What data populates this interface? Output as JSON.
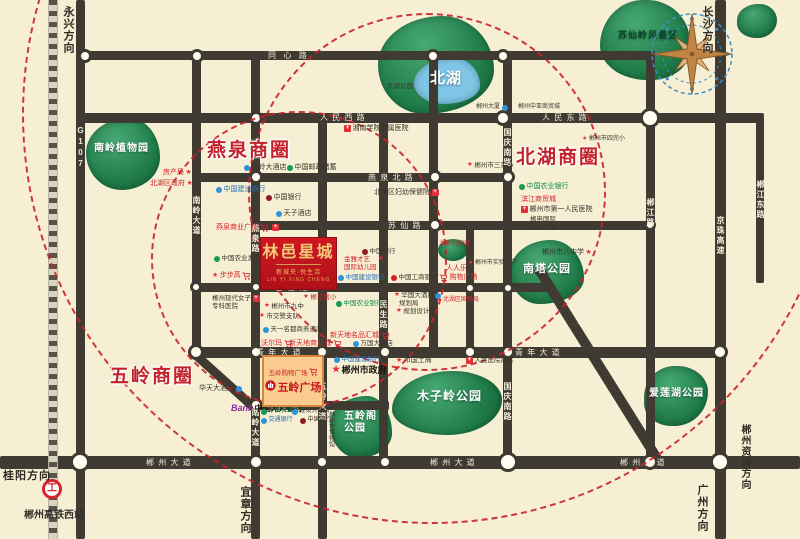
{
  "map": {
    "bg_color": "#f7efd4",
    "road_color": "#3f3b33",
    "circle_color": "#c9232b",
    "accent_red": "#c2232b",
    "brand": {
      "name": "林邑星城",
      "subtitle": "新城央·悦生活",
      "english": "LIN YI XING CHENG",
      "x": 260,
      "y": 237,
      "w": 77,
      "h": 53
    },
    "plaza": {
      "name": "五岭广场",
      "shop_label": "五岭购物广场",
      "x": 262,
      "y": 355,
      "w": 62,
      "h": 52
    },
    "station": {
      "label": "郴州高铁西站",
      "icon_x": 42,
      "icon_y": 479,
      "label_x": 24,
      "label_y": 506
    },
    "compass": {
      "x": 646,
      "y": 8
    },
    "railway": {
      "x": 48,
      "y": 0,
      "h": 539
    },
    "business_circles": [
      {
        "label": "燕泉商圈",
        "x": 207,
        "y": 135
      },
      {
        "label": "北湖商圈",
        "x": 516,
        "y": 142
      },
      {
        "label": "五岭商圈",
        "x": 110,
        "y": 361
      }
    ],
    "dashed_circles": [
      {
        "cx": 425,
        "cy": 190,
        "r": 177
      },
      {
        "cx": 297,
        "cy": 257,
        "r": 146
      },
      {
        "cx": 430,
        "cy": 112,
        "r": 408
      }
    ],
    "directions": [
      {
        "label": "永兴方向",
        "x": 60,
        "y": 6,
        "v": 1
      },
      {
        "label": "长沙方向",
        "x": 699,
        "y": 6,
        "v": 1
      },
      {
        "label": "桂阳方向",
        "x": 3,
        "y": 467,
        "v": 0
      },
      {
        "label": "宜章方向",
        "x": 237,
        "y": 486,
        "v": 1
      },
      {
        "label": "广州方向",
        "x": 694,
        "y": 484,
        "v": 1
      },
      {
        "label": "郴州资兴方向",
        "x": 737,
        "y": 424,
        "v": 1,
        "fs": 10
      }
    ],
    "roads": [
      {
        "x": 76,
        "y": 0,
        "w": 9,
        "h": 539
      },
      {
        "x": 192,
        "y": 51,
        "w": 9,
        "h": 306
      },
      {
        "x": 251,
        "y": 51,
        "w": 9,
        "h": 488
      },
      {
        "x": 318,
        "y": 113,
        "w": 9,
        "h": 426
      },
      {
        "x": 379,
        "y": 113,
        "w": 9,
        "h": 352
      },
      {
        "x": 429,
        "y": 51,
        "w": 9,
        "h": 306
      },
      {
        "x": 466,
        "y": 221,
        "w": 8,
        "h": 136
      },
      {
        "x": 503,
        "y": 51,
        "w": 9,
        "h": 414
      },
      {
        "x": 646,
        "y": 51,
        "w": 9,
        "h": 414
      },
      {
        "x": 715,
        "y": 0,
        "w": 11,
        "h": 539
      },
      {
        "x": 756,
        "y": 113,
        "w": 8,
        "h": 170
      },
      {
        "x": 80,
        "y": 51,
        "w": 572,
        "h": 9
      },
      {
        "x": 80,
        "y": 113,
        "w": 682,
        "h": 10
      },
      {
        "x": 196,
        "y": 173,
        "w": 316,
        "h": 9
      },
      {
        "x": 253,
        "y": 221,
        "w": 400,
        "h": 9
      },
      {
        "x": 196,
        "y": 283,
        "w": 352,
        "h": 9
      },
      {
        "x": 190,
        "y": 347,
        "w": 532,
        "h": 11
      },
      {
        "x": 251,
        "y": 401,
        "w": 138,
        "h": 9
      },
      {
        "x": 0,
        "y": 456,
        "w": 800,
        "h": 13
      },
      {
        "x": 194,
        "y": 349,
        "len": 84,
        "th": 9,
        "rot": 42
      },
      {
        "x": 538,
        "y": 263,
        "len": 234,
        "th": 10,
        "rot": 58
      }
    ],
    "junctions": [
      [
        85,
        56,
        7
      ],
      [
        197,
        56,
        7
      ],
      [
        433,
        56,
        7
      ],
      [
        503,
        56,
        7
      ],
      [
        650,
        118,
        10
      ],
      [
        503,
        118,
        8
      ],
      [
        256,
        118,
        7
      ],
      [
        256,
        177,
        7
      ],
      [
        435,
        177,
        7
      ],
      [
        508,
        177,
        7
      ],
      [
        435,
        225,
        7
      ],
      [
        650,
        225,
        6
      ],
      [
        196,
        287,
        6
      ],
      [
        256,
        287,
        6
      ],
      [
        470,
        288,
        6
      ],
      [
        508,
        288,
        6
      ],
      [
        196,
        352,
        8
      ],
      [
        256,
        352,
        7
      ],
      [
        322,
        352,
        7
      ],
      [
        385,
        352,
        7
      ],
      [
        470,
        352,
        7
      ],
      [
        508,
        352,
        7
      ],
      [
        720,
        352,
        8
      ],
      [
        256,
        405,
        7
      ],
      [
        322,
        405,
        6
      ],
      [
        80,
        462,
        10
      ],
      [
        256,
        462,
        8
      ],
      [
        322,
        462,
        7
      ],
      [
        385,
        462,
        7
      ],
      [
        508,
        462,
        10
      ],
      [
        650,
        462,
        8
      ],
      [
        720,
        462,
        10
      ]
    ],
    "road_labels": [
      {
        "t": "同  心  路",
        "x": 268,
        "y": 52
      },
      {
        "t": "人 民 西 路",
        "x": 320,
        "y": 114
      },
      {
        "t": "人 民 东 路",
        "x": 542,
        "y": 114
      },
      {
        "t": "燕 泉 北 路",
        "x": 368,
        "y": 174
      },
      {
        "t": "苏 仙 路",
        "x": 388,
        "y": 222
      },
      {
        "t": "香 雪 路",
        "x": 275,
        "y": 284
      },
      {
        "t": "青 年 大 道",
        "x": 256,
        "y": 349
      },
      {
        "t": "青 年 大 道",
        "x": 515,
        "y": 349
      },
      {
        "t": "日 月 路",
        "x": 266,
        "y": 402
      },
      {
        "t": "郴 州 大 道",
        "x": 146,
        "y": 459
      },
      {
        "t": "郴 州 大 道",
        "x": 430,
        "y": 459
      },
      {
        "t": "郴 州 大 道",
        "x": 620,
        "y": 459
      },
      {
        "t": "G107",
        "x": 76,
        "y": 126,
        "v": 1
      },
      {
        "t": "南岭大道",
        "x": 192,
        "y": 196,
        "v": 1
      },
      {
        "t": "燕泉路",
        "x": 251,
        "y": 224,
        "v": 1
      },
      {
        "t": "南岭大道",
        "x": 251,
        "y": 408,
        "v": 1
      },
      {
        "t": "五岭大道",
        "x": 318,
        "y": 382,
        "v": 1
      },
      {
        "t": "民生路",
        "x": 379,
        "y": 300,
        "v": 1
      },
      {
        "t": "国庆南路",
        "x": 503,
        "y": 128,
        "v": 1
      },
      {
        "t": "国庆南路",
        "x": 503,
        "y": 382,
        "v": 1
      },
      {
        "t": "郴江路",
        "x": 646,
        "y": 198,
        "v": 1
      },
      {
        "t": "京珠高速",
        "x": 716,
        "y": 216,
        "v": 1
      },
      {
        "t": "郴江东路",
        "x": 756,
        "y": 180,
        "v": 1
      },
      {
        "t": "南塔路",
        "x": 577,
        "y": 296,
        "v": 1
      }
    ],
    "parks": [
      {
        "n": "nanling-botanic-garden",
        "x": 86,
        "y": 118,
        "w": 74,
        "h": 72,
        "br": "58% 42% 52% 48% / 48% 55% 45% 52%",
        "label": "南岭植物园",
        "lx": 94,
        "ly": 143,
        "fs": 10,
        "lc": "#fff"
      },
      {
        "n": "beihu-park-green",
        "x": 378,
        "y": 16,
        "w": 116,
        "h": 98,
        "br": "55% 45% 60% 40% / 50% 55% 45% 50%"
      },
      {
        "n": "beihu-lake",
        "x": 414,
        "y": 58,
        "w": 66,
        "h": 46,
        "br": "60% 40% 55% 45% / 55% 60% 40% 45%",
        "fill": "#7fc6e6",
        "label": "北湖",
        "lx": 430,
        "ly": 70,
        "fs": 15,
        "lc": "#fff"
      },
      {
        "n": "suxianling-scenic",
        "x": 600,
        "y": 0,
        "w": 90,
        "h": 80,
        "br": "50% 50% 45% 55% / 60% 55% 40% 45%",
        "label": "苏仙岭风景区",
        "lx": 618,
        "ly": 30,
        "fs": 9,
        "lc": "#0c4226"
      },
      {
        "n": "corner-green",
        "x": 737,
        "y": 4,
        "w": 40,
        "h": 34,
        "br": "55% 45% 50% 50% / 50% 50% 55% 45%"
      },
      {
        "n": "pocket-garden",
        "x": 438,
        "y": 239,
        "w": 30,
        "h": 22,
        "br": "50%"
      },
      {
        "n": "nanta-park",
        "x": 510,
        "y": 240,
        "w": 74,
        "h": 64,
        "br": "55% 45% 60% 40% / 50% 60% 40% 50%",
        "label": "南塔公园",
        "lx": 523,
        "ly": 263,
        "fs": 11,
        "lc": "#fff"
      },
      {
        "n": "wulingge-park",
        "x": 330,
        "y": 396,
        "w": 62,
        "h": 62,
        "br": "60% 40% 55% 45% / 45% 60% 40% 55%",
        "label": "五岭阁\n公园",
        "lx": 344,
        "ly": 411,
        "fs": 10,
        "lc": "#fff"
      },
      {
        "n": "muziling-park",
        "x": 392,
        "y": 371,
        "w": 110,
        "h": 64,
        "br": "55% 45% 50% 50% / 60% 45% 55% 40%",
        "label": "木子岭公园",
        "lx": 417,
        "ly": 390,
        "fs": 12,
        "lc": "#fff"
      },
      {
        "n": "ailianhu-park",
        "x": 644,
        "y": 366,
        "w": 64,
        "h": 60,
        "br": "50% 50% 55% 45% / 55% 45% 60% 40%",
        "label": "爱莲湖公园",
        "lx": 649,
        "ly": 388,
        "fs": 10,
        "lc": "#fff"
      }
    ],
    "pois": [
      {
        "t": "房产局",
        "x": 163,
        "y": 169,
        "c": "r",
        "q": "star"
      },
      {
        "t": "北湖区政府",
        "x": 150,
        "y": 180,
        "c": "r",
        "q": "star"
      },
      {
        "t": "五岭大酒店",
        "x": 244,
        "y": 164,
        "c": "d",
        "p": "dot-b"
      },
      {
        "t": "中国邮政储蓄",
        "x": 287,
        "y": 164,
        "c": "d",
        "p": "dot-g"
      },
      {
        "t": "中国建设银行",
        "x": 216,
        "y": 186,
        "c": "b",
        "p": "dot-b"
      },
      {
        "t": "中国银行",
        "x": 266,
        "y": 194,
        "c": "d",
        "p": "dot-m"
      },
      {
        "t": "天子酒店",
        "x": 276,
        "y": 210,
        "c": "d",
        "p": "dot-b"
      },
      {
        "t": "二四零医院",
        "x": 272,
        "y": 224,
        "c": "d",
        "p": "cross"
      },
      {
        "t": "燕泉商业广场",
        "x": 216,
        "y": 224,
        "c": "r",
        "q": "cart"
      },
      {
        "t": "中国农业发展银行",
        "x": 214,
        "y": 255,
        "c": "d",
        "p": "dot-g",
        "f": 6.5
      },
      {
        "t": "步步高",
        "x": 212,
        "y": 272,
        "c": "r",
        "p": "star",
        "q": "cart"
      },
      {
        "t": "郴州现代女子\n专科医院",
        "x": 212,
        "y": 295,
        "c": "d",
        "q": "cross",
        "f": 6.5
      },
      {
        "t": "郴江南小",
        "x": 303,
        "y": 294,
        "c": "r",
        "p": "star",
        "f": 6.5
      },
      {
        "t": "郴州市九中",
        "x": 264,
        "y": 303,
        "c": "d",
        "p": "star",
        "f": 6.5
      },
      {
        "t": "市交警支队",
        "x": 259,
        "y": 313,
        "c": "d",
        "p": "star",
        "f": 6.5
      },
      {
        "t": "天一名都商务酒店",
        "x": 263,
        "y": 326,
        "c": "d",
        "p": "dot-b",
        "f": 6.5
      },
      {
        "t": "沃尔玛",
        "x": 261,
        "y": 340,
        "c": "r",
        "q": "cart"
      },
      {
        "t": "新天地商业城",
        "x": 289,
        "y": 340,
        "c": "r",
        "q": "cart"
      },
      {
        "t": "新天地名品汇城",
        "x": 330,
        "y": 332,
        "c": "r",
        "q": "cart"
      },
      {
        "t": "万国大酒店",
        "x": 353,
        "y": 340,
        "c": "d",
        "p": "dot-b",
        "f": 6.5
      },
      {
        "t": "中国建设银行",
        "x": 334,
        "y": 356,
        "c": "b",
        "p": "dot-b",
        "f": 6.5
      },
      {
        "t": "郴州市政府",
        "x": 332,
        "y": 365,
        "c": "k",
        "p": "star",
        "f": 9,
        "b": 1
      },
      {
        "t": "市国土局",
        "x": 396,
        "y": 357,
        "c": "d",
        "p": "star"
      },
      {
        "t": "人民医院南院",
        "x": 466,
        "y": 357,
        "c": "d",
        "p": "cross",
        "f": 6.5
      },
      {
        "t": "北湖区国税局",
        "x": 436,
        "y": 297,
        "c": "r",
        "p": "star",
        "f": 6
      },
      {
        "t": "人人乐",
        "x": 446,
        "y": 265,
        "c": "r"
      },
      {
        "t": "购物广场",
        "x": 439,
        "y": 274,
        "c": "r",
        "p": "cart"
      },
      {
        "t": "郴州市实验中学",
        "x": 468,
        "y": 260,
        "c": "d",
        "p": "star",
        "f": 6
      },
      {
        "t": "金雅才艺\n国际幼儿园",
        "x": 344,
        "y": 256,
        "c": "r",
        "q": "star",
        "f": 6.5
      },
      {
        "t": "中国银行",
        "x": 362,
        "y": 248,
        "c": "d",
        "p": "dot-m",
        "f": 6.5
      },
      {
        "t": "中国建设银行",
        "x": 338,
        "y": 274,
        "c": "b",
        "p": "dot-b",
        "f": 6.5
      },
      {
        "t": "中国工商银行",
        "x": 391,
        "y": 274,
        "c": "d",
        "p": "dot-r",
        "f": 6.5
      },
      {
        "t": "华国大酒店",
        "x": 394,
        "y": 292,
        "c": "d",
        "p": "star",
        "q": "dot-b",
        "f": 6.5
      },
      {
        "t": "规划局",
        "x": 399,
        "y": 300,
        "c": "d",
        "f": 6.5
      },
      {
        "t": "规划设计院",
        "x": 396,
        "y": 308,
        "c": "d",
        "p": "star",
        "f": 6.5
      },
      {
        "t": "中国农业银行",
        "x": 336,
        "y": 300,
        "c": "g",
        "p": "dot-g",
        "f": 6.5
      },
      {
        "t": "北湖区妇幼保健院",
        "x": 374,
        "y": 189,
        "c": "d",
        "q": "cross"
      },
      {
        "t": "郴州市三完小",
        "x": 467,
        "y": 162,
        "c": "d",
        "p": "star",
        "f": 6.5
      },
      {
        "t": "郴州中亚商贸城",
        "x": 518,
        "y": 104,
        "c": "d",
        "f": 6
      },
      {
        "t": "郴州市四完小",
        "x": 582,
        "y": 136,
        "c": "d",
        "p": "star",
        "f": 6
      },
      {
        "t": "中国农业银行",
        "x": 519,
        "y": 183,
        "c": "g",
        "p": "dot-g"
      },
      {
        "t": "滨江商贸城",
        "x": 521,
        "y": 196,
        "c": "r"
      },
      {
        "t": "郴州市第一人民医院",
        "x": 521,
        "y": 206,
        "c": "d",
        "p": "cross"
      },
      {
        "t": "郴电国际\n翡翠广场",
        "x": 530,
        "y": 216,
        "c": "d",
        "f": 6.5
      },
      {
        "t": "郴州市八中学",
        "x": 542,
        "y": 249,
        "c": "d",
        "q": "star"
      },
      {
        "t": "郴州大厦",
        "x": 476,
        "y": 104,
        "c": "d",
        "q": "dot-b",
        "f": 6
      },
      {
        "t": "湘南学院附属医院",
        "x": 344,
        "y": 125,
        "c": "d",
        "p": "cross"
      },
      {
        "t": "北湖公园",
        "x": 387,
        "y": 83,
        "c": "d",
        "f": 6.5
      },
      {
        "t": "华天大酒店",
        "x": 199,
        "y": 385,
        "c": "d",
        "q": "dot-b"
      },
      {
        "t": "中国光大银行",
        "x": 231,
        "y": 404,
        "c": "k",
        "p": "ebank",
        "f": 8,
        "b": 1
      },
      {
        "t": "中国农业银行",
        "x": 261,
        "y": 408,
        "c": "g",
        "p": "dot-g",
        "f": 6
      },
      {
        "t": "建设大酒店",
        "x": 292,
        "y": 408,
        "c": "d",
        "p": "dot-b",
        "f": 6
      },
      {
        "t": "交通银行",
        "x": 261,
        "y": 417,
        "c": "b",
        "p": "dot-b",
        "f": 6
      },
      {
        "t": "中国银行",
        "x": 300,
        "y": 417,
        "c": "d",
        "p": "dot-m",
        "f": 6
      },
      {
        "t": "郴州市博物馆",
        "x": 326,
        "y": 411,
        "c": "d",
        "f": 6,
        "v": 1
      },
      {
        "t": "龙泉小游园",
        "x": 439,
        "y": 241,
        "c": "r",
        "f": 6
      }
    ]
  }
}
